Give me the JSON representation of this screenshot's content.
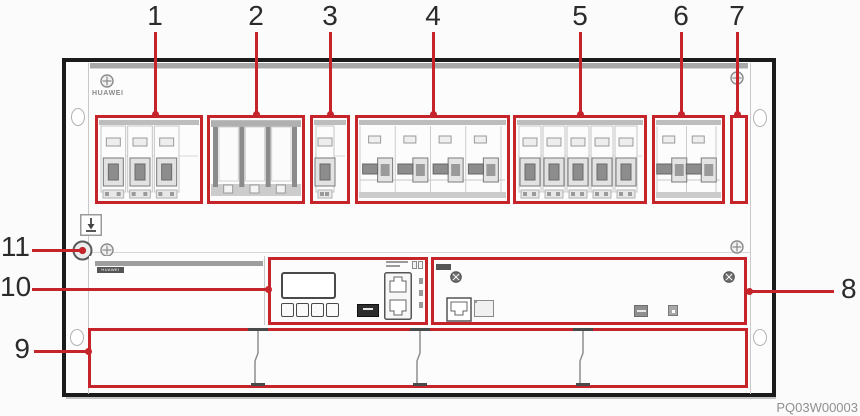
{
  "figure": {
    "brand_logo": "HUAWEI",
    "module_logo": "HUAWEI",
    "watermark": "PQ03W00003"
  },
  "colors": {
    "annotation_red": "#c5242b",
    "frame_black": "#1b1b1b"
  },
  "callouts": {
    "top": [
      {
        "label": "1",
        "x": 155
      },
      {
        "label": "2",
        "x": 256
      },
      {
        "label": "3",
        "x": 330
      },
      {
        "label": "4",
        "x": 433
      },
      {
        "label": "5",
        "x": 580
      },
      {
        "label": "6",
        "x": 681
      },
      {
        "label": "7",
        "x": 737
      }
    ],
    "left": [
      {
        "label": "11",
        "line_y": 250,
        "line_x1": 32,
        "line_x2": 82,
        "text_top": 233
      },
      {
        "label": "10",
        "line_y": 289,
        "line_x1": 32,
        "line_x2": 268,
        "text_top": 273
      },
      {
        "label": "9",
        "line_y": 351,
        "line_x1": 34,
        "line_x2": 88,
        "text_top": 335
      }
    ],
    "right": [
      {
        "label": "8",
        "line_y": 291,
        "line_x1": 748,
        "line_x2": 834,
        "text_left": 841,
        "text_top": 275
      }
    ]
  },
  "breaker_groups": [
    {
      "label": "1",
      "x": 95,
      "w": 108,
      "style": "front",
      "units": 3,
      "pad_right": 18
    },
    {
      "label": "2",
      "x": 207,
      "w": 98,
      "style": "links",
      "units": 3,
      "pad_right": 4
    },
    {
      "label": "3",
      "x": 310,
      "w": 40,
      "style": "front",
      "units": 1,
      "pad_right": 10
    },
    {
      "label": "4",
      "x": 355,
      "w": 155,
      "style": "side",
      "units": 4,
      "pad_right": 4
    },
    {
      "label": "5",
      "x": 513,
      "w": 134,
      "style": "front",
      "units": 5,
      "pad_right": 4
    },
    {
      "label": "6",
      "x": 652,
      "w": 73,
      "style": "side",
      "units": 2,
      "pad_right": 4
    },
    {
      "label": "7",
      "x": 730,
      "w": 18,
      "style": "empty",
      "units": 0,
      "pad_right": 0
    }
  ],
  "signal_board": {
    "terminal_groups": 7,
    "wide_connectors": 2,
    "small_connectors": 5
  },
  "filler_panels": {
    "count": 4,
    "divider_xs": [
      258,
      420,
      583
    ]
  }
}
